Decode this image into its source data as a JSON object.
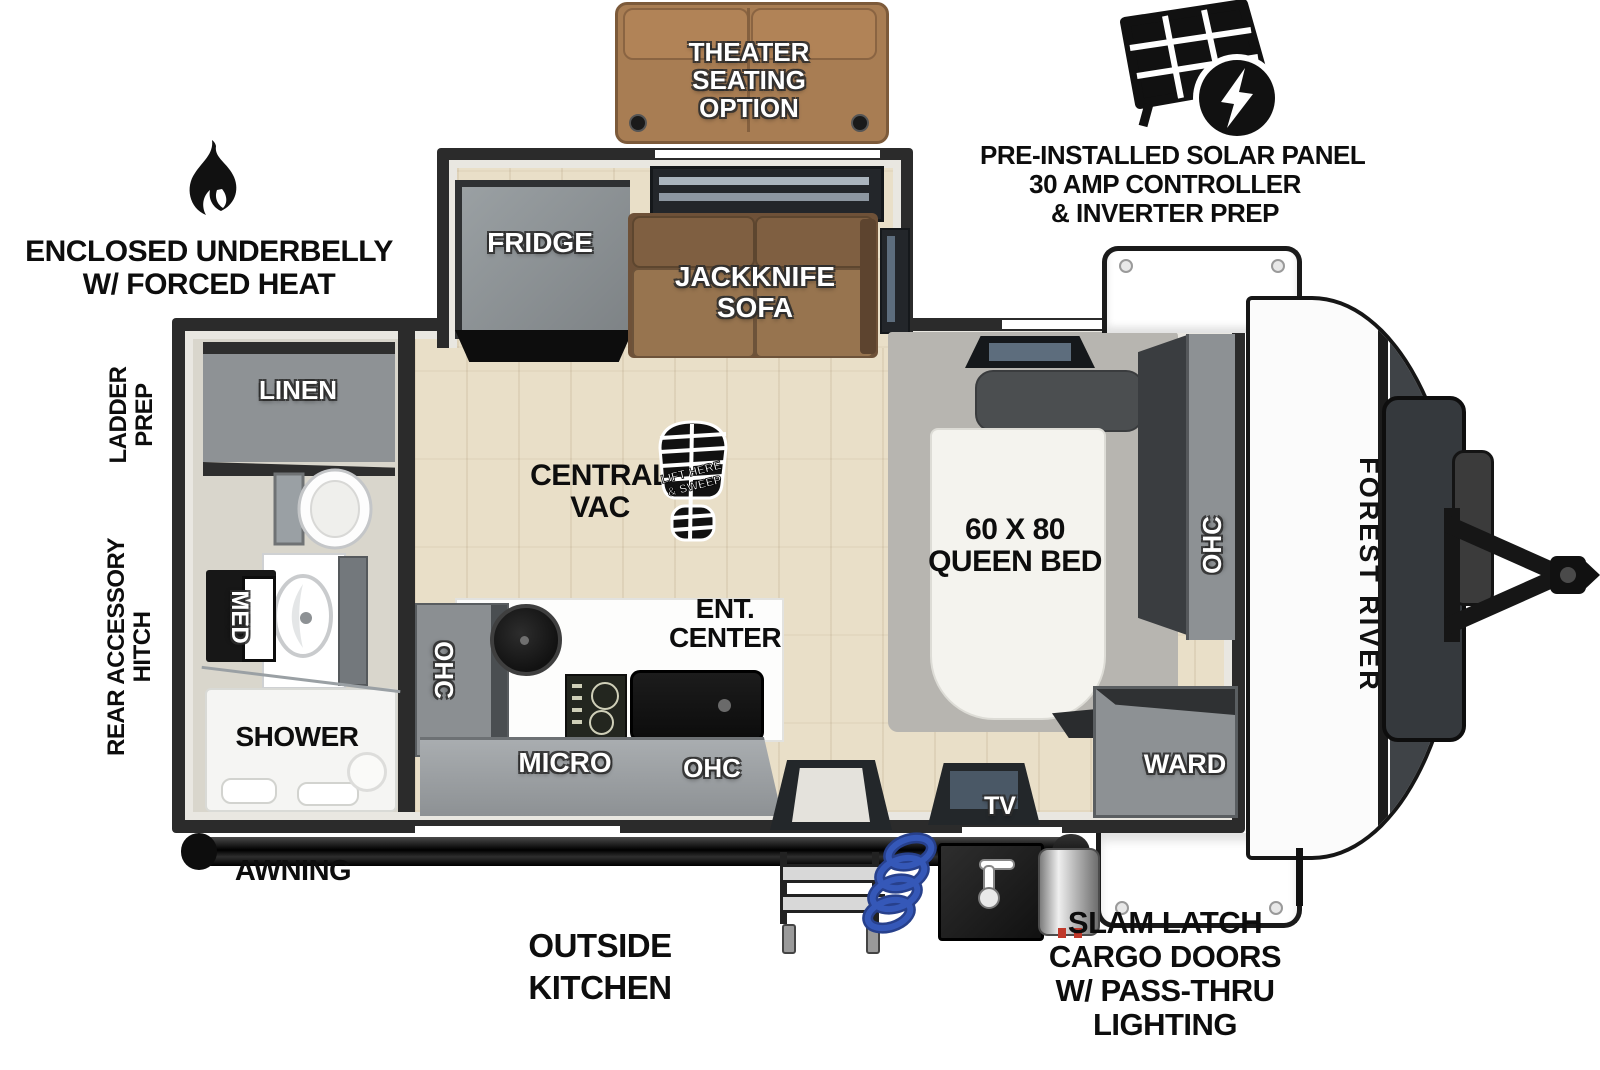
{
  "annotations": {
    "theater_seating": {
      "line1": "THEATER",
      "line2": "SEATING",
      "line3": "OPTION"
    },
    "solar": {
      "line1": "PRE-INSTALLED SOLAR PANEL",
      "line2": "30 AMP CONTROLLER",
      "line3": "& INVERTER PREP"
    },
    "underbelly": {
      "line1": "ENCLOSED UNDERBELLY",
      "line2": "W/ FORCED HEAT"
    },
    "ladder_prep": {
      "line1": "LADDER",
      "line2": "PREP"
    },
    "rear_hitch": {
      "line1": "REAR ACCESSORY",
      "line2": "HITCH"
    },
    "awning": {
      "label": "AWNING"
    },
    "outside_kitchen": {
      "line1": "OUTSIDE",
      "line2": "KITCHEN"
    },
    "cargo_doors": {
      "line1": "SLAM LATCH",
      "line2": "CARGO DOORS",
      "line3": "W/ PASS-THRU",
      "line4": "LIGHTING"
    }
  },
  "interior": {
    "fridge": "FRIDGE",
    "jackknife": {
      "line1": "JACKKNIFE",
      "line2": "SOFA"
    },
    "central_vac": {
      "line1": "CENTRAL",
      "line2": "VAC"
    },
    "bootprint": {
      "line1": "LIFT HERE",
      "line2": "& SWEEP"
    },
    "ent_center": {
      "line1": "ENT.",
      "line2": "CENTER"
    },
    "queen_bed": {
      "line1": "60 X 80",
      "line2": "QUEEN BED"
    },
    "kitchen_ohc": "OHC",
    "micro": "MICRO",
    "counter_ohc": "OHC",
    "bed_ohc": "OHC",
    "ward": "WARD",
    "tv": "TV",
    "linen": "LINEN",
    "med": "MED",
    "shower": "SHOWER"
  },
  "brand": {
    "name": "FOREST RIVER"
  },
  "colors": {
    "wall": "#2b2b2b",
    "floor_wood": "#e9dfc8",
    "floor_bath": "#d9d6cc",
    "cabinet_gray": "#8e9295",
    "cabinet_dark": "#44484b",
    "sofa_brown": "#7a5c40",
    "theater_tan": "#a87d53",
    "mattress_white": "#f4f3ee",
    "hose_blue": "#3558b8"
  }
}
